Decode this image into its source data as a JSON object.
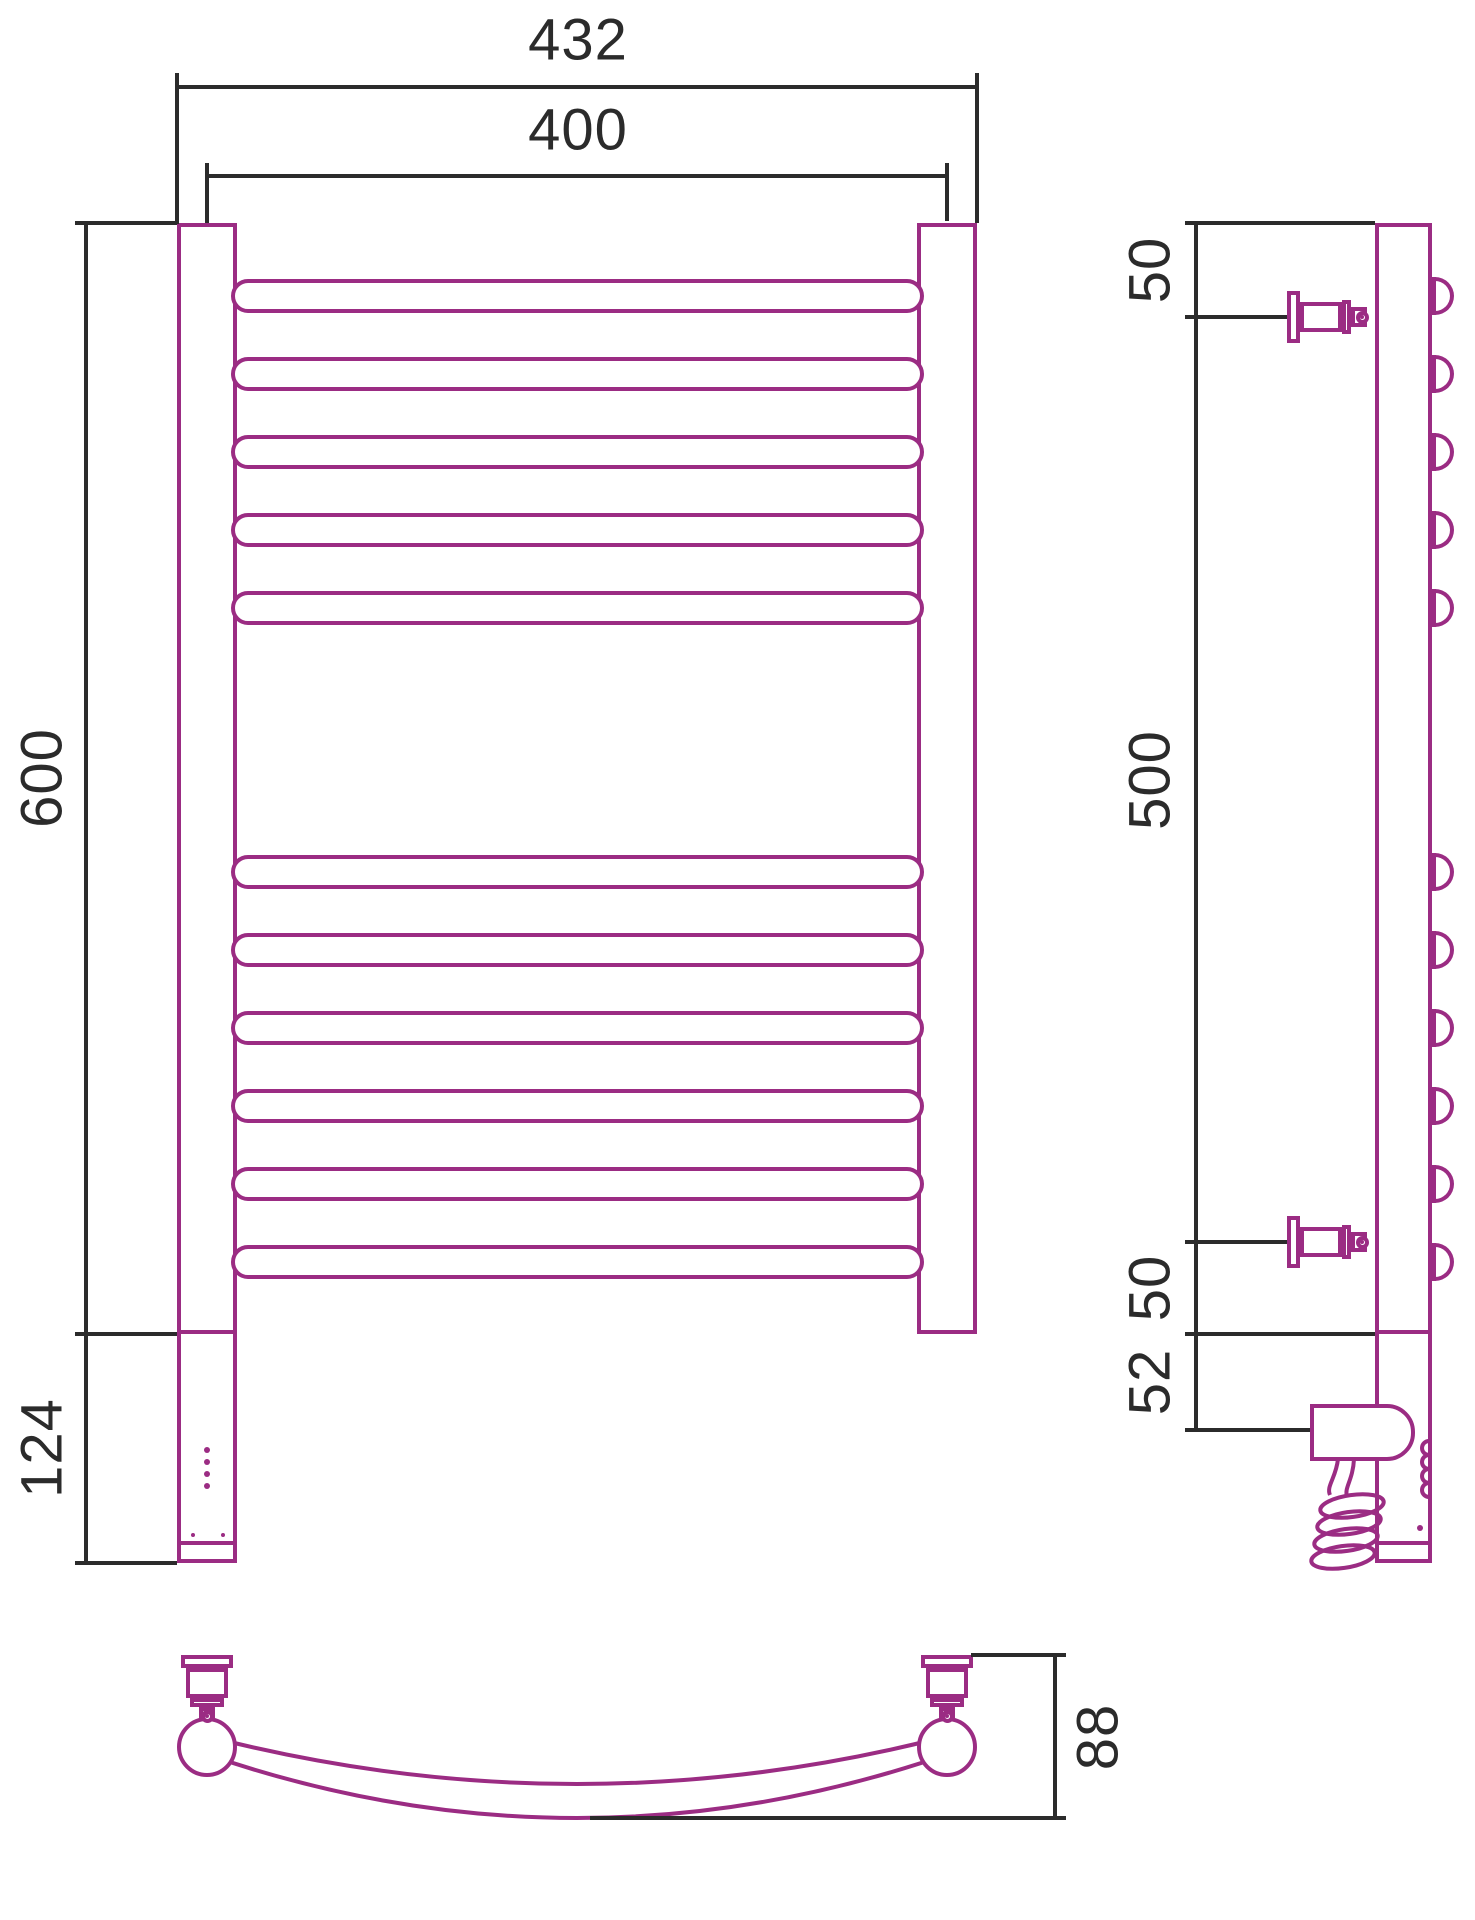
{
  "title": "heated-towel-rail-technical-drawing",
  "colors": {
    "line": "#9B2C83",
    "dim": "#2B2B2B",
    "bg": "#FFFFFF"
  },
  "dims": {
    "top_outer": "432",
    "top_inner": "400",
    "height": "600",
    "lower_unit": "124",
    "side_top": "50",
    "side_mid": "500",
    "side_bottom": "50",
    "side_unit": "52",
    "depth": "88"
  },
  "figure": {
    "canvas": {
      "w": 1475,
      "h": 1920
    },
    "stroke": 4,
    "svg_under": [
      {
        "name": "bottom-view-tube-arc-outer",
        "d": "M200,1752 Q577,1884 954,1752"
      },
      {
        "name": "bottom-view-tube-arc-inner",
        "d": "M214,1738 Q577,1830 940,1738"
      }
    ],
    "bumps": {
      "x": 1432,
      "w": 22,
      "h": 38,
      "r": "0 19px 19px 0",
      "centers": [
        296,
        374,
        452,
        530,
        608,
        872,
        950,
        1028,
        1106,
        1184,
        1262
      ]
    },
    "back": [
      {
        "name": "front-post-left",
        "x": 177,
        "y": 223,
        "w": 60,
        "h": 1111
      },
      {
        "name": "front-post-right",
        "x": 917,
        "y": 223,
        "w": 60,
        "h": 1111
      },
      {
        "name": "side-profile-bar",
        "x": 1375,
        "y": 223,
        "w": 57,
        "h": 1111
      },
      {
        "name": "front-electric-unit",
        "x": 177,
        "y": 1330,
        "w": 60,
        "h": 215
      },
      {
        "name": "front-unit-endcap",
        "x": 177,
        "y": 1541,
        "w": 60,
        "h": 22
      },
      {
        "name": "side-electric-unit",
        "x": 1375,
        "y": 1330,
        "w": 57,
        "h": 215
      },
      {
        "name": "side-unit-endcap",
        "x": 1375,
        "y": 1541,
        "w": 57,
        "h": 22
      }
    ],
    "rungs": {
      "x": 231,
      "w": 693,
      "h": 34,
      "r": "17px",
      "tops": [
        279,
        357,
        435,
        513,
        591,
        855,
        933,
        1011,
        1089,
        1167,
        1245
      ]
    },
    "front": [
      {
        "name": "side-heater-box",
        "x": 1310,
        "y": 1404,
        "w": 105,
        "h": 57,
        "r": "0 28px 28px 0"
      },
      {
        "name": "side-bracket-top-flange",
        "x": 1287,
        "y": 291,
        "w": 13,
        "h": 52
      },
      {
        "name": "side-bracket-top-body",
        "x": 1300,
        "y": 302,
        "w": 42,
        "h": 30
      },
      {
        "name": "side-bracket-top-plate",
        "x": 1342,
        "y": 300,
        "w": 9,
        "h": 34
      },
      {
        "name": "side-bracket-top-knob",
        "x": 1351,
        "y": 307,
        "w": 16,
        "h": 20
      },
      {
        "name": "side-bracket-bottom-flange",
        "x": 1287,
        "y": 1216,
        "w": 13,
        "h": 52
      },
      {
        "name": "side-bracket-bottom-body",
        "x": 1300,
        "y": 1227,
        "w": 42,
        "h": 30
      },
      {
        "name": "side-bracket-bottom-plate",
        "x": 1342,
        "y": 1225,
        "w": 9,
        "h": 34
      },
      {
        "name": "side-bracket-bottom-knob",
        "x": 1351,
        "y": 1232,
        "w": 16,
        "h": 20
      },
      {
        "name": "bottom-bracket-left-flange",
        "x": 181,
        "y": 1655,
        "w": 52,
        "h": 13
      },
      {
        "name": "bottom-bracket-left-body",
        "x": 186,
        "y": 1668,
        "w": 42,
        "h": 30
      },
      {
        "name": "bottom-bracket-left-plate",
        "x": 190,
        "y": 1698,
        "w": 34,
        "h": 9
      },
      {
        "name": "bottom-bracket-left-knob",
        "x": 199,
        "y": 1707,
        "w": 16,
        "h": 20
      },
      {
        "name": "bottom-bracket-right-flange",
        "x": 921,
        "y": 1655,
        "w": 52,
        "h": 13
      },
      {
        "name": "bottom-bracket-right-body",
        "x": 926,
        "y": 1668,
        "w": 42,
        "h": 30
      },
      {
        "name": "bottom-bracket-right-plate",
        "x": 930,
        "y": 1698,
        "w": 34,
        "h": 9
      },
      {
        "name": "bottom-bracket-right-knob",
        "x": 939,
        "y": 1707,
        "w": 16,
        "h": 20
      }
    ],
    "black": [
      {
        "name": "ext-432-left",
        "x": 175,
        "y": 73,
        "w": 4,
        "h": 151
      },
      {
        "name": "ext-432-right",
        "x": 975,
        "y": 73,
        "w": 4,
        "h": 150
      },
      {
        "name": "dim-432-line",
        "x": 175,
        "y": 85,
        "w": 804,
        "h": 4
      },
      {
        "name": "ext-400-left",
        "x": 205,
        "y": 163,
        "w": 4,
        "h": 60
      },
      {
        "name": "ext-400-right",
        "x": 945,
        "y": 163,
        "w": 4,
        "h": 58
      },
      {
        "name": "dim-400-line",
        "x": 205,
        "y": 174,
        "w": 744,
        "h": 4
      },
      {
        "name": "dim-600-line",
        "x": 84,
        "y": 221,
        "w": 4,
        "h": 1344
      },
      {
        "name": "tick-600-top",
        "x": 75,
        "y": 221,
        "w": 102,
        "h": 4
      },
      {
        "name": "tick-600-bottom",
        "x": 75,
        "y": 1332,
        "w": 102,
        "h": 4
      },
      {
        "name": "tick-124-bottom",
        "x": 75,
        "y": 1561,
        "w": 102,
        "h": 4
      },
      {
        "name": "dim-side-line",
        "x": 1194,
        "y": 221,
        "w": 4,
        "h": 1211
      },
      {
        "name": "tick-side-top",
        "x": 1185,
        "y": 221,
        "w": 190,
        "h": 4
      },
      {
        "name": "tick-side-50a",
        "x": 1185,
        "y": 315,
        "w": 102,
        "h": 4
      },
      {
        "name": "tick-side-50b",
        "x": 1185,
        "y": 1240,
        "w": 102,
        "h": 4
      },
      {
        "name": "tick-side-base",
        "x": 1185,
        "y": 1332,
        "w": 190,
        "h": 4
      },
      {
        "name": "tick-side-52",
        "x": 1185,
        "y": 1428,
        "w": 125,
        "h": 4
      },
      {
        "name": "dim-88-line",
        "x": 1053,
        "y": 1655,
        "w": 4,
        "h": 163
      },
      {
        "name": "tick-88-top",
        "x": 971,
        "y": 1653,
        "w": 95,
        "h": 4
      },
      {
        "name": "tick-88-bottom",
        "x": 590,
        "y": 1816,
        "w": 476,
        "h": 4
      }
    ],
    "circles": [
      {
        "name": "bottom-view-post-left",
        "cx": 207,
        "cy": 1747,
        "r": 30
      },
      {
        "name": "bottom-view-post-right",
        "cx": 947,
        "cy": 1747,
        "r": 30
      },
      {
        "name": "screw-head-side-top",
        "cx": 1362,
        "cy": 317,
        "r": 6.5
      },
      {
        "name": "screw-head-side-bottom",
        "cx": 1362,
        "cy": 1242,
        "r": 6.5
      },
      {
        "name": "screw-head-bottom-left",
        "cx": 207,
        "cy": 1716,
        "r": 6.5
      },
      {
        "name": "screw-head-bottom-right",
        "cx": 947,
        "cy": 1716,
        "r": 6.5
      },
      {
        "name": "screw-dot-side-top",
        "cx": 1362,
        "cy": 317,
        "r": 2,
        "fill": true
      },
      {
        "name": "screw-dot-side-bottom",
        "cx": 1362,
        "cy": 1242,
        "r": 2,
        "fill": true
      },
      {
        "name": "screw-dot-bottom-left",
        "cx": 207,
        "cy": 1716,
        "r": 2,
        "fill": true
      },
      {
        "name": "screw-dot-bottom-right",
        "cx": 947,
        "cy": 1716,
        "r": 2,
        "fill": true
      },
      {
        "name": "led-indicator-1",
        "cx": 207,
        "cy": 1450,
        "r": 3,
        "fill": true
      },
      {
        "name": "led-indicator-2",
        "cx": 207,
        "cy": 1462,
        "r": 3,
        "fill": true
      },
      {
        "name": "led-indicator-3",
        "cx": 207,
        "cy": 1474,
        "r": 3,
        "fill": true
      },
      {
        "name": "led-indicator-4",
        "cx": 207,
        "cy": 1486,
        "r": 3,
        "fill": true
      },
      {
        "name": "unit-screw-left",
        "cx": 193,
        "cy": 1535,
        "r": 2,
        "fill": true
      },
      {
        "name": "unit-screw-right",
        "cx": 223,
        "cy": 1535,
        "r": 2,
        "fill": true
      },
      {
        "name": "side-unit-led",
        "cx": 1420,
        "cy": 1528,
        "r": 3,
        "fill": true
      }
    ],
    "svg_over": [
      {
        "name": "power-cord-line-1",
        "d": "M1338,1459 C1336,1478 1326,1486 1330,1495"
      },
      {
        "name": "power-cord-line-2",
        "d": "M1354,1459 C1353,1480 1344,1488 1347,1496"
      },
      {
        "name": "heating-element-symbol",
        "d": "M1429,1441 a7,7 0 0 0 0,14 a7,7 0 0 0 0,14 a7,7 0 0 0 0,14 a7,7 0 0 0 0,14"
      }
    ],
    "coil": [
      {
        "name": "cord-coil-loop-1",
        "cx": 1352,
        "cy": 1506,
        "rx": 32,
        "ry": 11,
        "rot": -8
      },
      {
        "name": "cord-coil-loop-2",
        "cx": 1349,
        "cy": 1523,
        "rx": 32,
        "ry": 11,
        "rot": -8
      },
      {
        "name": "cord-coil-loop-3",
        "cx": 1346,
        "cy": 1540,
        "rx": 32,
        "ry": 11,
        "rot": -8
      },
      {
        "name": "cord-coil-loop-4",
        "cx": 1343,
        "cy": 1557,
        "rx": 32,
        "ry": 11,
        "rot": -8
      }
    ]
  }
}
